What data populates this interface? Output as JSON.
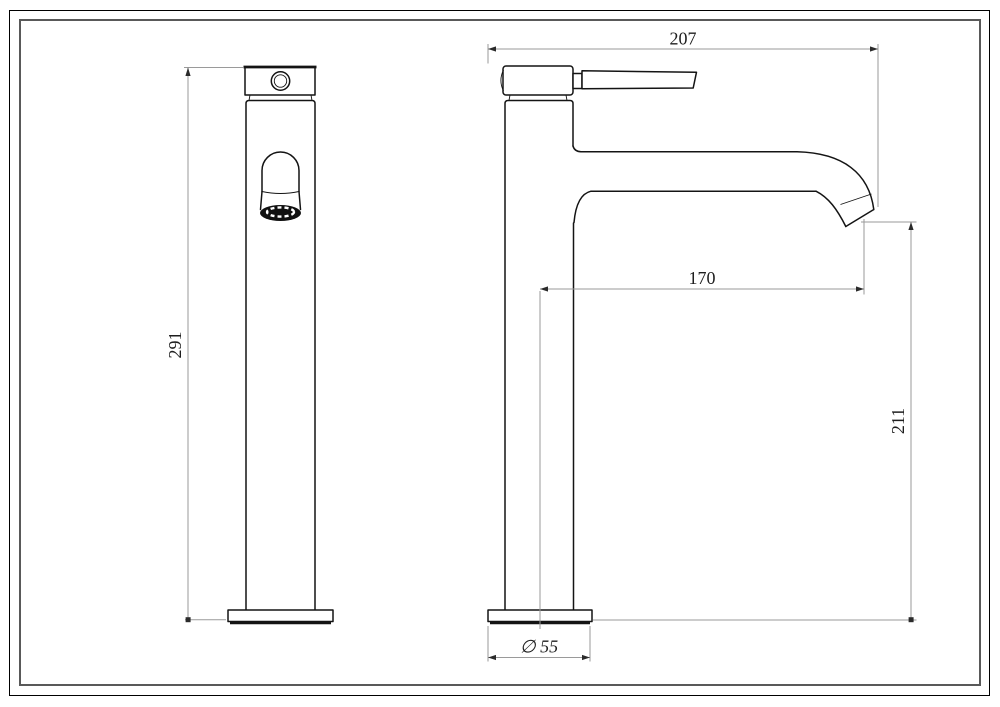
{
  "document": {
    "type": "technical dimension drawing",
    "subject": "tall single-lever basin mixer faucet",
    "views": {
      "front_view": "front orthographic view",
      "side_view": "side orthographic view"
    }
  },
  "dimensions": {
    "front_height": "291",
    "overall_depth": "207",
    "spout_reach": "170",
    "outlet_height": "211",
    "base_diameter": "∅ 55"
  },
  "colors": {
    "background": "#ffffff",
    "outline": "#141414",
    "dimension_line": "#9a9a9a",
    "dimension_text": "#1e1e1e",
    "inner_frame": "#595959",
    "outer_frame": "#000000"
  }
}
